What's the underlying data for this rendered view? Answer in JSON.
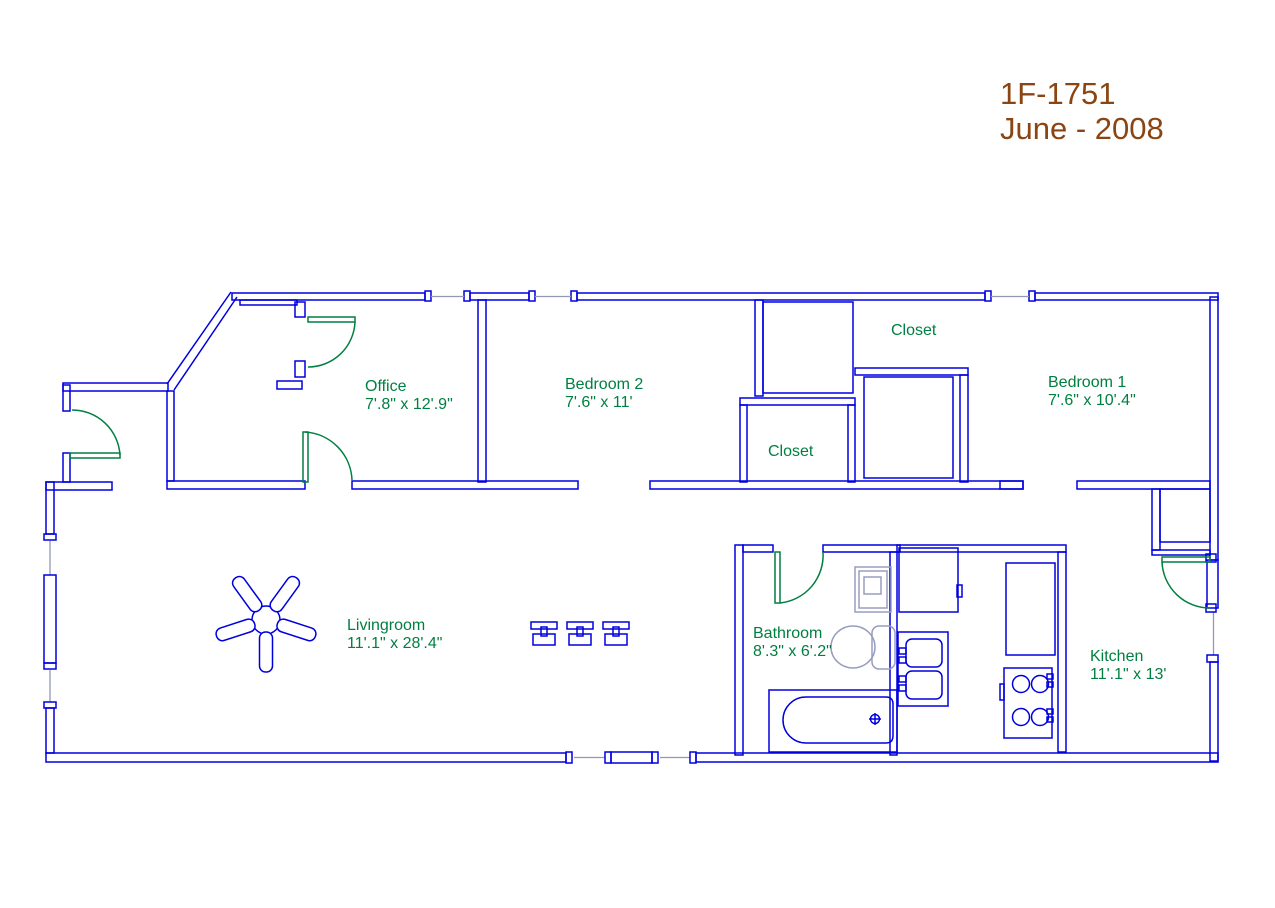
{
  "title": {
    "line1": "1F-1751",
    "line2": "June - 2008"
  },
  "rooms": {
    "office": {
      "name": "Office",
      "dims": "7'.8\" x 12'.9\""
    },
    "bedroom2": {
      "name": "Bedroom 2",
      "dims": "7'.6\" x 11'"
    },
    "closet_top": {
      "name": "Closet"
    },
    "bedroom1": {
      "name": "Bedroom 1",
      "dims": "7'.6\" x 10'.4\""
    },
    "closet_mid": {
      "name": "Closet"
    },
    "livingroom": {
      "name": "Livingroom",
      "dims": "11'.1\" x 28'.4\""
    },
    "bathroom": {
      "name": "Bathroom",
      "dims": "8'.3\" x 6'.2\""
    },
    "kitchen": {
      "name": "Kitchen",
      "dims": "11'.1\" x 13'"
    }
  },
  "fixtures": [
    "ceiling-fan",
    "floor-boxes",
    "bathtub",
    "toilet",
    "pedestal-sink",
    "laundry-sink",
    "utility-cabinet",
    "kitchen-counter",
    "stove",
    "entry-door",
    "office-doors",
    "bathroom-door",
    "kitchen-door",
    "windows"
  ],
  "colors": {
    "wall": "#0000dd",
    "door": "#007f40",
    "label": "#008040",
    "title": "#8a4513",
    "window_glass": "#9298b8",
    "fixture_gray": "#989dbe",
    "background": "#ffffff"
  }
}
